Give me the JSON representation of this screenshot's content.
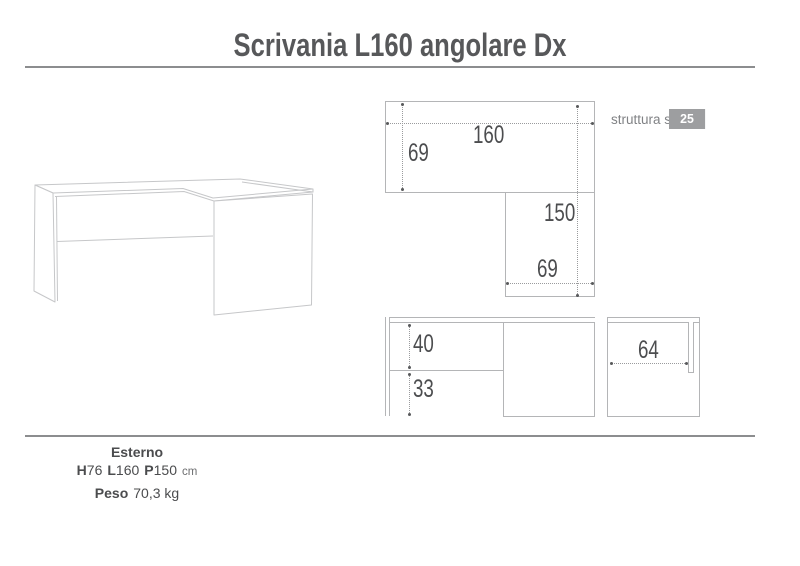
{
  "title": "Scrivania L160 angolare Dx",
  "structure_note": {
    "label": "struttura sp.",
    "value": "25 mm"
  },
  "views": {
    "plan": {
      "width_top": "160",
      "depth_left": "69",
      "depth_return": "150",
      "width_return": "69"
    },
    "front": {
      "upper_height": "40",
      "lower_height": "33"
    },
    "side": {
      "inner_width": "64"
    }
  },
  "specs": {
    "heading": "Esterno",
    "dims": [
      {
        "label": "H",
        "value": "76"
      },
      {
        "label": "L",
        "value": "160"
      },
      {
        "label": "P",
        "value": "150"
      }
    ],
    "dims_unit": "cm",
    "weight_label": "Peso",
    "weight_value": "70,3 kg"
  },
  "colors": {
    "title_text": "#57585a",
    "rule_line": "#8c8d8f",
    "drawing_line": "#b4b5b7",
    "iso_line": "#c6c7c9",
    "dim_text": "#4c4d4f",
    "badge_background": "#9d9ea0",
    "badge_text": "#ffffff"
  }
}
